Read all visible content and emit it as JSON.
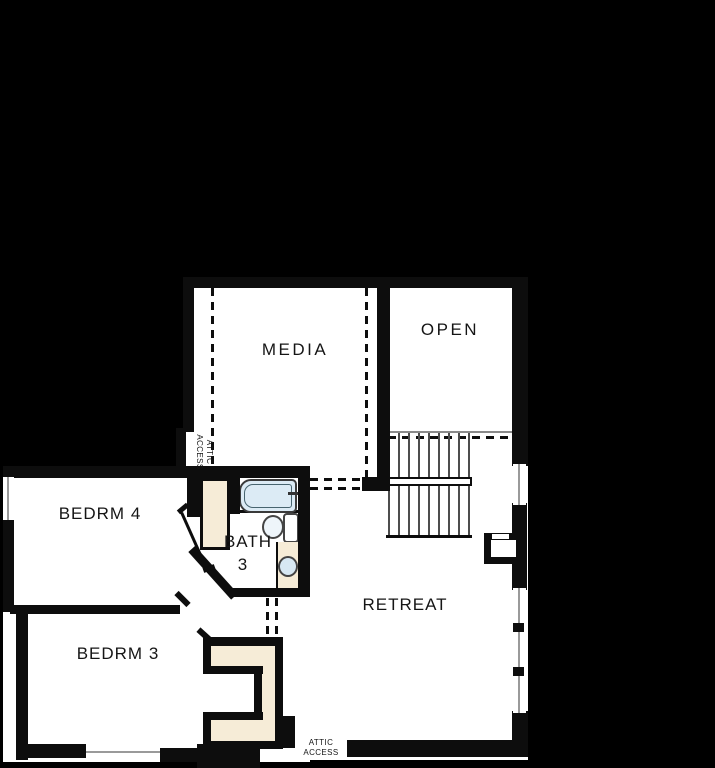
{
  "rooms": {
    "media": {
      "label": "MEDIA"
    },
    "open": {
      "label": "OPEN"
    },
    "bedrm4": {
      "label": "BEDRM 4"
    },
    "bath3": {
      "line1": "BATH",
      "line2": "3"
    },
    "bedrm3": {
      "label": "BEDRM 3"
    },
    "retreat": {
      "label": "RETREAT"
    }
  },
  "annotations": {
    "attic_left": {
      "line1": "ATTIC",
      "line2": "ACCESS"
    },
    "attic_bottom": {
      "line1": "ATTIC",
      "line2": "ACCESS"
    }
  },
  "colors": {
    "background": "#000000",
    "floor": "#ffffff",
    "wall": "#0d0d0d",
    "fixture_beige": "#f6ecd7",
    "tub_blue": "#dcebf5",
    "fixture_line": "#47646f",
    "stair_line": "#4d4d4d",
    "window_line": "#9a9a9a"
  }
}
